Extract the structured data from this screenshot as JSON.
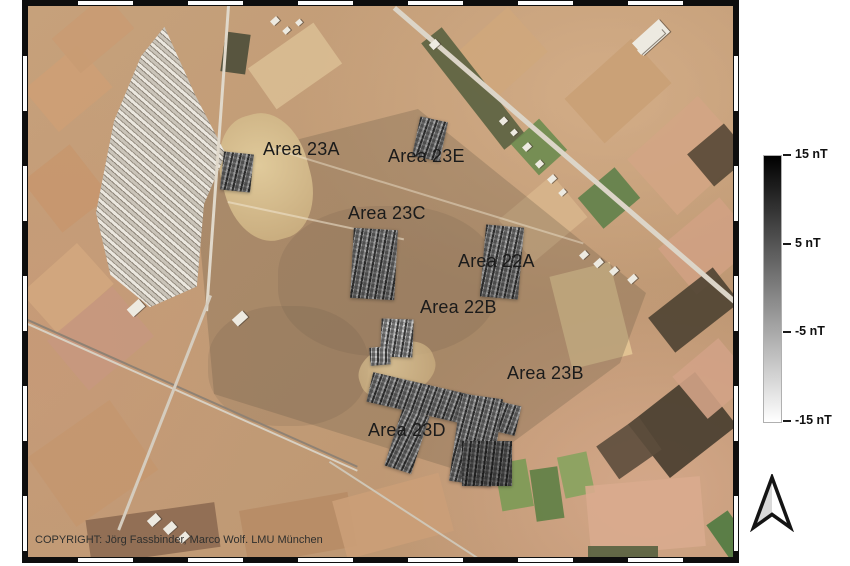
{
  "figure": {
    "copyright": "COPYRIGHT: Jörg Fassbinder, Marco Wolf. LMU München"
  },
  "map": {
    "description": "Satellite image with magnetometry survey areas",
    "area_labels": [
      {
        "id": "area-23a",
        "label": "Area 23A",
        "x": 235,
        "y": 133
      },
      {
        "id": "area-23e",
        "label": "Area 23E",
        "x": 360,
        "y": 140
      },
      {
        "id": "area-23c",
        "label": "Area 23C",
        "x": 320,
        "y": 197
      },
      {
        "id": "area-22a",
        "label": "Area 22A",
        "x": 430,
        "y": 245
      },
      {
        "id": "area-22b",
        "label": "Area 22B",
        "x": 392,
        "y": 291
      },
      {
        "id": "area-23b",
        "label": "Area 23B",
        "x": 479,
        "y": 357
      },
      {
        "id": "area-23d",
        "label": "Area 23D",
        "x": 340,
        "y": 414
      }
    ]
  },
  "legend": {
    "unit": "nT",
    "gradient_top_color": "#000000",
    "gradient_bottom_color": "#ffffff",
    "ticks": [
      {
        "label": "15 nT",
        "position": 0
      },
      {
        "label": "5 nT",
        "position": 0.333
      },
      {
        "label": "-5 nT",
        "position": 0.667
      },
      {
        "label": "-15 nT",
        "position": 1
      }
    ]
  }
}
